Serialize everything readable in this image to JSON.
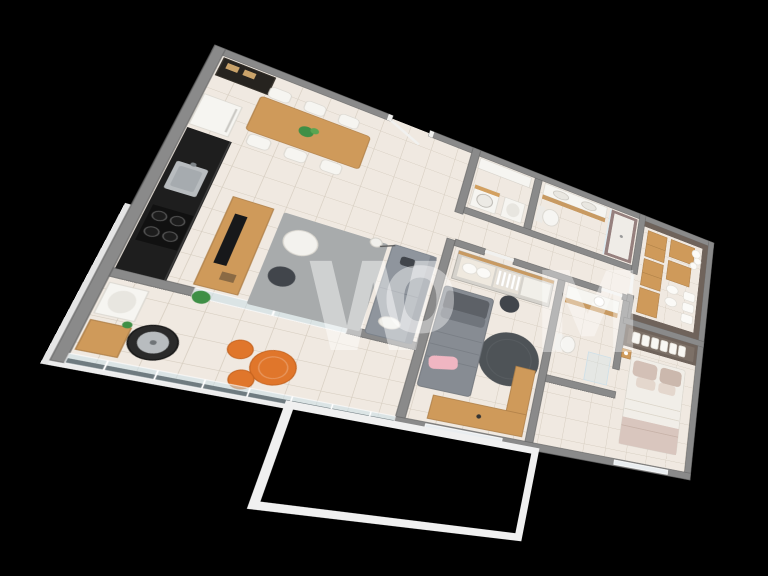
{
  "scene": {
    "type": "3d-isometric-floorplan-render",
    "background": "#000000",
    "watermark": {
      "letter1": "W",
      "letter2": "O",
      "letter3": "M",
      "color": "rgba(255,255,255,0.45)"
    }
  },
  "palette": {
    "bg": "#000000",
    "floor": "#f0e9e1",
    "tileLine": "rgba(160,145,122,0.32)",
    "wall": "#8a8a8a",
    "wallEdge": "#6a6a6a",
    "wood": "#cf9a5a",
    "woodEdge": "#ae7f48",
    "dark": "#1e1e1e",
    "steel": "#b8bcbf",
    "white": "#f6f5f1",
    "whiteEdge": "#d8d5ce",
    "sofa": "#8f959d",
    "sofaEdge": "#767d86",
    "sofaDark": "#41454b",
    "rug": "#a8abac",
    "rugRound": "#4e5357",
    "bedGray": "#878c93",
    "bedGrayEdge": "#6f747b",
    "pillowDark": "#5d6167",
    "pink": "#f0b6c2",
    "duvet": "#f1eee8",
    "duvetEdge": "#d8d4cb",
    "pillowBeige": "#d3c0b6",
    "throw": "#d9c6be",
    "taupe": "#6f635b",
    "taupeLight": "#7c7067",
    "mauve": "#96807e",
    "orange": "#e0762b",
    "orangeEdge": "#c4621e",
    "green": "#3f8f46",
    "greenLight": "#5aa552",
    "glass": "rgba(203,224,233,0.55)",
    "slab": "#f0f0f0",
    "watermark": "rgba(255,255,255,0.45)"
  },
  "rooms": [
    {
      "id": "kitchen",
      "furniture": [
        "display-cabinet",
        "refrigerator",
        "black-counter",
        "steel-sink",
        "cooktop-4-burners"
      ]
    },
    {
      "id": "dining-area",
      "furniture": [
        "wood-dining-table",
        "six-white-chairs",
        "plant-centerpiece"
      ]
    },
    {
      "id": "living-room",
      "furniture": [
        "wood-tv-console",
        "tv",
        "gray-area-rug",
        "gray-sofa",
        "white-pouf",
        "dark-pouf",
        "floor-lamp",
        "plant"
      ]
    },
    {
      "id": "gourmet-balcony",
      "furniture": [
        "round-grill",
        "utility-sink",
        "wood-cabinet",
        "orange-bistro-table",
        "two-orange-chairs",
        "glass-railing"
      ]
    },
    {
      "id": "laundry-room",
      "furniture": [
        "washing-machine",
        "counter",
        "laundry-tub"
      ]
    },
    {
      "id": "bathroom-1",
      "furniture": [
        "toilet",
        "double-sink-vanity",
        "shower-mauve-walls"
      ]
    },
    {
      "id": "hallway",
      "furniture": [
        "doors"
      ]
    },
    {
      "id": "bedroom-2",
      "furniture": [
        "single-gray-bed",
        "pink-pillow",
        "charcoal-round-rug",
        "wood-desk",
        "wardrobe-open-shelves",
        "dark-pouf"
      ]
    },
    {
      "id": "bathroom-2",
      "furniture": [
        "wood-vanity-round-basin",
        "toilet",
        "glass-shower"
      ]
    },
    {
      "id": "walk-in-closet",
      "furniture": [
        "tan-dresser-boxes",
        "linen-shelves-white-stacks",
        "white-pillows"
      ]
    },
    {
      "id": "master-bedroom",
      "furniture": [
        "double-bed-white-duvet",
        "beige-pillows",
        "taupe-wardrobe-linen-shelf",
        "nightstand-lamp"
      ]
    }
  ]
}
